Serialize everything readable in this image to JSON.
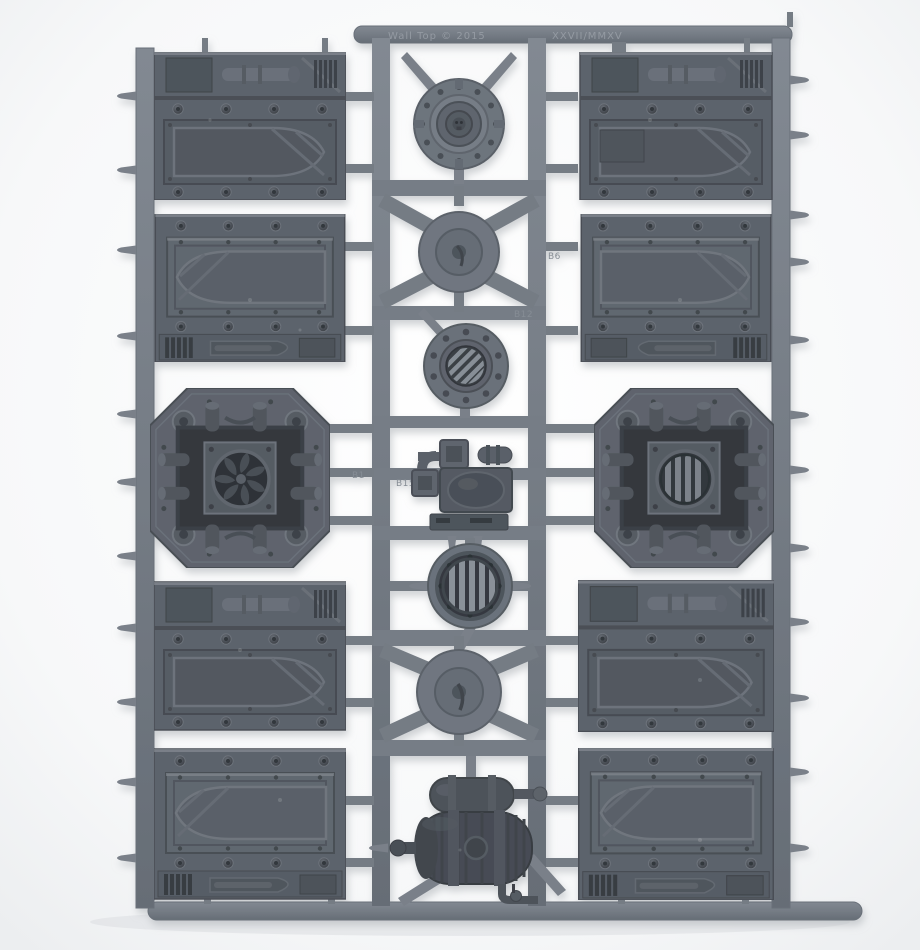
{
  "scene": {
    "subject": "grey plastic model kit sprue with armoured wall panels, hatches, vents and tank parts",
    "background": "#f6f7f8",
    "sprue_color": "#757c85",
    "panel_color": "#5c636c",
    "recess_color": "#3b4046",
    "shadow_color": "#c3c7cb"
  },
  "embossed": {
    "top_left_mark": "Wall Top © 2015",
    "top_right_mark": "XXVII/MMXV",
    "labels": {
      "b1": "B1",
      "b15": "B15",
      "b6": "B6",
      "b12": "B12"
    }
  },
  "parts": {
    "door_panel": "armoured-door-panel",
    "machinery_fan": "octagonal-machinery-panel-fan",
    "machinery_vent": "octagonal-machinery-panel-louvre",
    "hatch": "round-hatch-skull-boss",
    "louvre_vent": "round-louvred-vent",
    "barred_grille": "round-barred-grille",
    "spike_hub": "cone-spike-hub",
    "pump_cluster": "pipe-pump-cluster",
    "tank": "ribbed-tank-assembly"
  }
}
